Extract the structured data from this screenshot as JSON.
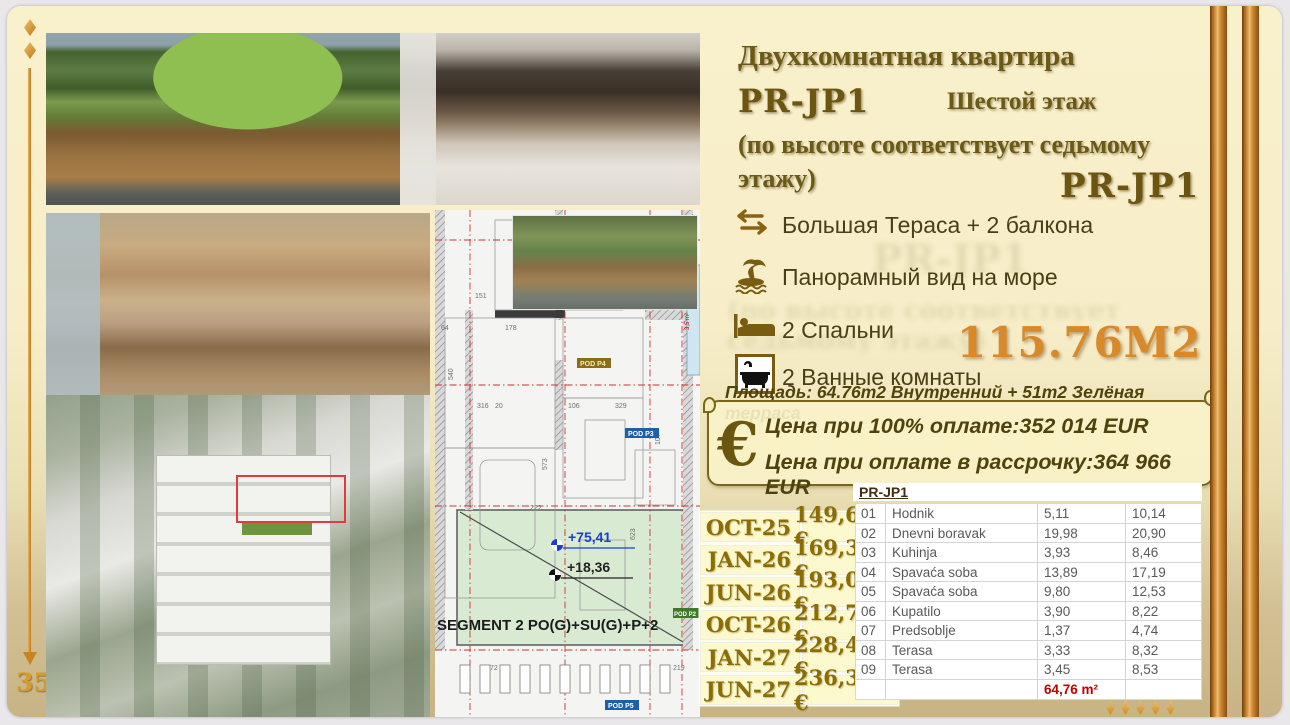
{
  "page": {
    "number": "35"
  },
  "title": {
    "line1": "Двухкомнатная квартира",
    "code": "PR-JP1",
    "floor": "Шестой этаж",
    "note": "(по высоте соответствует седьмому этажу)",
    "code2": "PR-JP1"
  },
  "features": {
    "0": {
      "icon": "swap-arrows-icon",
      "text": "Большая  Тераса + 2 балкона"
    },
    "1": {
      "icon": "palm-island-icon",
      "text": "Панорамный вид на море"
    },
    "2": {
      "icon": "bed-icon",
      "text": "2 Спальни"
    },
    "3": {
      "icon": "bathtub-icon",
      "text": "2 Ванные комнаты"
    }
  },
  "area": {
    "total": "115.76М2",
    "note": "Площадь: 64.76m2 Внутренний + 51m2 Зелёная терраса",
    "euro_symbol": "€",
    "price_full": "Цена при 100% оплате:352 014 EUR",
    "price_installment": "Цена при оплате в рассрочку:364 966 EUR"
  },
  "payment": {
    "rows": {
      "0": {
        "date": "OCT-25",
        "value": "149,682 €"
      },
      "1": {
        "date": "JAN-26",
        "value": "169,377 €"
      },
      "2": {
        "date": "JUN-26",
        "value": "193,011 €"
      },
      "3": {
        "date": "OCT-26",
        "value": "212,706 €"
      },
      "4": {
        "date": "JAN-27",
        "value": "228,462 €"
      },
      "5": {
        "date": "JUN-27",
        "value": "236,340 €"
      }
    }
  },
  "room_table": {
    "header": "PR-JP1",
    "rows": {
      "0": {
        "no": "01",
        "name": "Hodnik",
        "v1": "5,11",
        "v2": "10,14"
      },
      "1": {
        "no": "02",
        "name": "Dnevni boravak",
        "v1": "19,98",
        "v2": "20,90"
      },
      "2": {
        "no": "03",
        "name": "Kuhinja",
        "v1": "3,93",
        "v2": "8,46"
      },
      "3": {
        "no": "04",
        "name": "Spavaća soba",
        "v1": "13,89",
        "v2": "17,19"
      },
      "4": {
        "no": "05",
        "name": "Spavaća soba",
        "v1": "9,80",
        "v2": "12,53"
      },
      "5": {
        "no": "06",
        "name": "Kupatilo",
        "v1": "3,90",
        "v2": "8,22"
      },
      "6": {
        "no": "07",
        "name": "Predsoblje",
        "v1": "1,37",
        "v2": "4,74"
      },
      "7": {
        "no": "08",
        "name": "Terasa",
        "v1": "3,33",
        "v2": "8,32"
      },
      "8": {
        "no": "09",
        "name": "Terasa",
        "v1": "3,45",
        "v2": "8,53"
      }
    },
    "total": "64,76 m²"
  },
  "plan": {
    "elev_blue": "+75,41",
    "elev_black": "+18,36",
    "segment": "SEGMENT 2 PO(G)+SU(G)+P+2",
    "pod_p4": "POD P4",
    "pod_p3": "POD P3",
    "pod_p5": "POD P5",
    "pod_p2": "POD P2",
    "pool_area": "3,5 m²",
    "dims": {
      "0": "151",
      "1": "178",
      "2": "316",
      "3": "106",
      "4": "329",
      "5": "222",
      "6": "573",
      "7": "107",
      "8": "623",
      "9": "540",
      "10": "72",
      "11": "219",
      "12": "94",
      "13": "44",
      "14": "64",
      "15": "20"
    }
  },
  "colors": {
    "accent_orange": "#d8892a",
    "dark_gold": "#6b5a16",
    "payment_text": "#8c6d05",
    "total_red": "#c00000",
    "stripe_copper": "#b1701f",
    "slide_cream": "#f8efca",
    "slide_tan": "#c7b385"
  }
}
